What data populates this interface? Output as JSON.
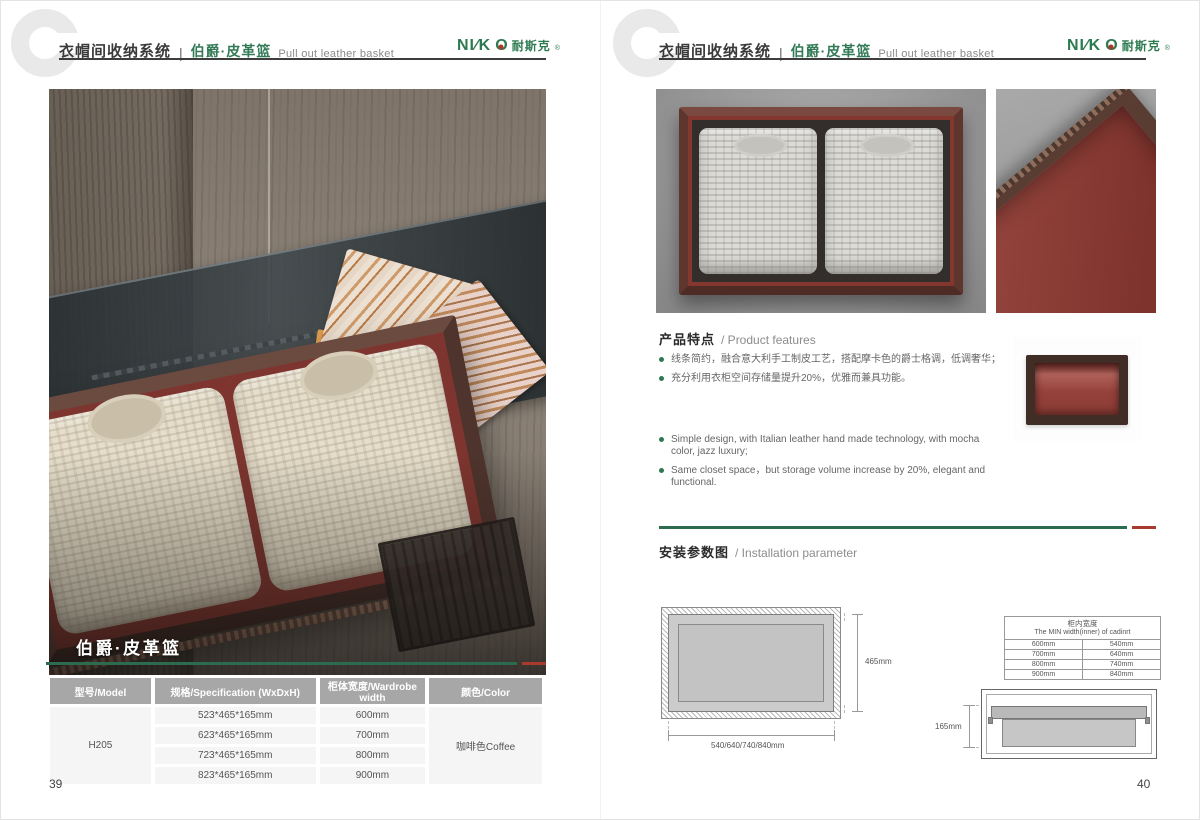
{
  "brand": {
    "logo_part1": "NI∕K",
    "logo_o": "O",
    "logo_cn": "耐斯克",
    "reg": "®"
  },
  "header": {
    "title_cn": "衣帽间收纳系统",
    "separator": "|",
    "product_cn": "伯爵·皮革篮",
    "product_en": "Pull out leather basket"
  },
  "left_page": {
    "photo_caption": "伯爵·皮革篮",
    "page_number": "39",
    "table": {
      "headers": [
        "型号/Model",
        "规格/Specification (WxDxH)",
        "柜体宽度/Wardrobe width",
        "颜色/Color"
      ],
      "model": "H205",
      "rows": [
        {
          "spec": "523*465*165mm",
          "width": "600mm"
        },
        {
          "spec": "623*465*165mm",
          "width": "700mm"
        },
        {
          "spec": "723*465*165mm",
          "width": "800mm"
        },
        {
          "spec": "823*465*165mm",
          "width": "900mm"
        }
      ],
      "color": "咖啡色Coffee"
    }
  },
  "right_page": {
    "page_number": "40",
    "features": {
      "heading_cn": "产品特点",
      "heading_en": "/ Product features",
      "bullets_cn": [
        "线条简约，融合意大利手工制皮工艺，搭配摩卡色的爵士格调，低调奢华；",
        "充分利用衣柜空间存储量提升20%，优雅而兼具功能。"
      ],
      "bullets_en": [
        "Simple design, with Italian leather hand made technology, with mocha color, jazz  luxury;",
        "Same closet space，but storage volume increase by 20%, elegant and functional."
      ]
    },
    "installation": {
      "heading_cn": "安装参数图",
      "heading_en": "/ Installation parameter",
      "top_view": {
        "height_label": "465mm",
        "width_label": "540/640/740/840mm"
      },
      "min_width_table": {
        "title_cn": "柜内宽度",
        "title_en": "The MIN width(inner) of cadinrt",
        "rows": [
          [
            "600mm",
            "540mm"
          ],
          [
            "700mm",
            "640mm"
          ],
          [
            "800mm",
            "740mm"
          ],
          [
            "900mm",
            "840mm"
          ]
        ]
      },
      "side_view": {
        "height_label": "165mm"
      }
    }
  },
  "colors": {
    "brand_green": "#2e7a50",
    "line_green": "#2d6b4f",
    "line_red": "#a93a2e",
    "table_header_bg": "#a7a7a8",
    "leather_red": "#8a3a34",
    "frame_brown": "#5a3d32"
  }
}
